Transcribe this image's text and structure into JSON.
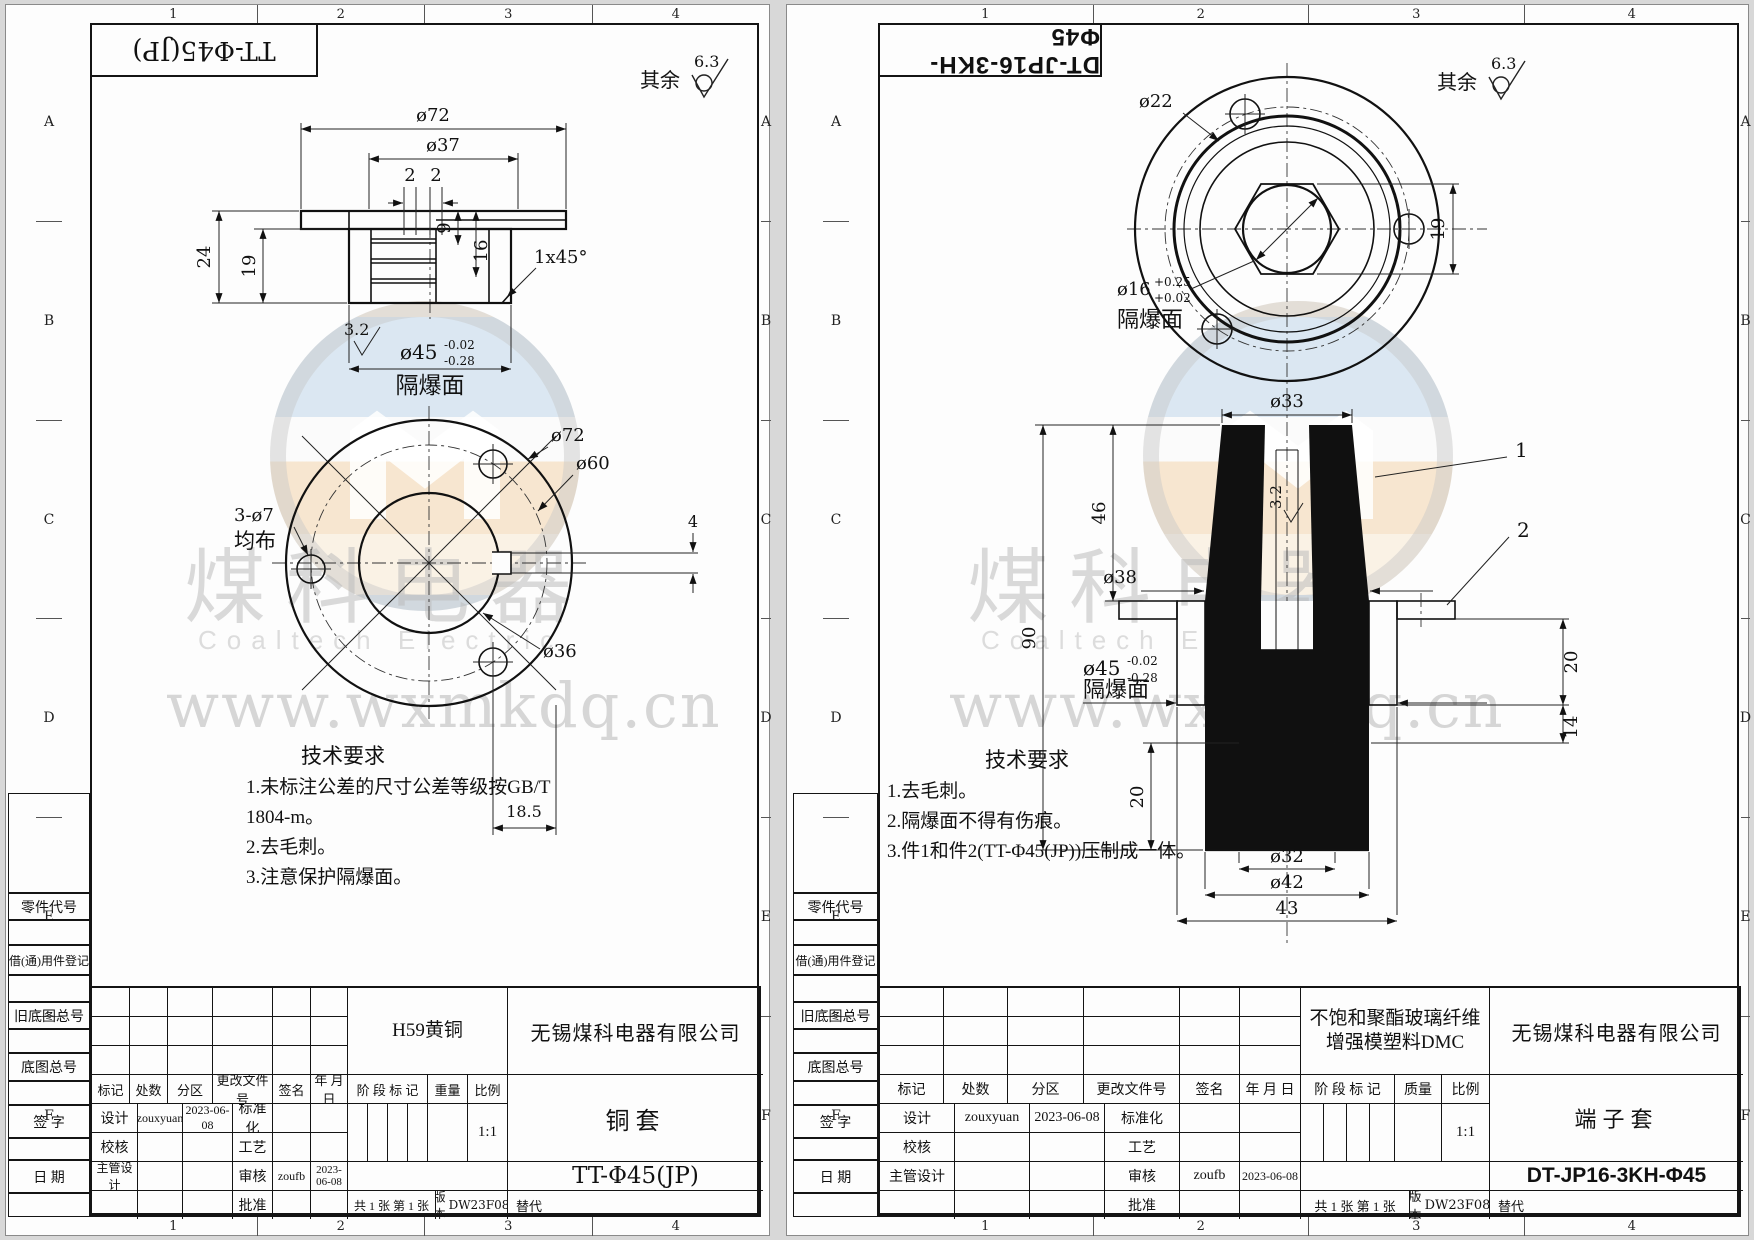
{
  "watermark": {
    "cn": "煤科电器",
    "en": "Coaltech Electric",
    "url": "www.wxmkdq.cn"
  },
  "zones": {
    "c": [
      "1",
      "2",
      "3",
      "4"
    ],
    "r": [
      "A",
      "B",
      "C",
      "D",
      "E",
      "F"
    ]
  },
  "margin_labels": [
    "零件代号",
    "借(通)用件登记",
    "旧底图总号",
    "底图总号",
    "签 字",
    "日 期"
  ],
  "tb_labels": {
    "mark": "标记",
    "count": "处数",
    "zone": "分区",
    "change": "更改文件号",
    "sign": "签名",
    "date": "年 月 日",
    "design": "设计",
    "standardize": "标准化",
    "check": "校核",
    "process": "工艺",
    "chief_design": "主管设计",
    "audit": "审核",
    "approve": "批准",
    "stage": "阶 段 标 记",
    "scale": "比例",
    "sheets": "共 1 张  第 1 张",
    "version": "版本",
    "replace": "替代"
  },
  "left": {
    "stamp": "TT-Φ45(JP)",
    "rough_rest": "其余",
    "rough_val": "6.3",
    "fv": {
      "d72": "ø72",
      "d37": "ø37",
      "g1": "2",
      "g2": "2",
      "h24": "24",
      "h19": "19",
      "d9": "9",
      "d16": "16",
      "chamfer": "1x45°",
      "rough": "3.2",
      "d45": "ø45",
      "d45u": "-0.02",
      "d45d": "-0.28",
      "face": "隔爆面"
    },
    "bv": {
      "d72": "ø72",
      "d60": "ø60",
      "d36": "ø36",
      "holes": "3-ø7",
      "even": "均布",
      "key": "4",
      "off": "18.5"
    },
    "tech": {
      "t": "技术要求",
      "i1": "1.未标注公差的尺寸公差等级按GB/T 1804-m。",
      "i2": "2.去毛刺。",
      "i3": "3.注意保护隔爆面。"
    },
    "tb": {
      "material1": "H59黄铜",
      "material2": "",
      "company": "无锡煤科电器有限公司",
      "part": "铜套",
      "no": "TT-Φ45(JP)",
      "scale": "1:1",
      "weight": "重量",
      "designer": "zouxyuan",
      "ddate": "2023-06-08",
      "auditor": "zoufb",
      "adate": "2023-06-08",
      "version": "DW23F08"
    }
  },
  "right": {
    "stamp": "DT-JP16-3KH-Φ45",
    "rough_rest": "其余",
    "rough_val": "6.3",
    "cv": {
      "d22": "ø22",
      "d16": "ø16",
      "d16u": "+0.25",
      "d16d": "+0.02",
      "face": "隔爆面",
      "h19": "19"
    },
    "sv": {
      "d33": "ø33",
      "h46": "46",
      "h90": "90",
      "d38": "ø38",
      "d45": "ø45",
      "d45u": "-0.02",
      "d45d": "-0.28",
      "face": "隔爆面",
      "rough": "3.2",
      "h20l": "20",
      "h20r": "20",
      "h14": "14",
      "d32": "ø32",
      "d42": "ø42",
      "w43": "43",
      "b1": "1",
      "b2": "2"
    },
    "tech": {
      "t": "技术要求",
      "i1": "1.去毛刺。",
      "i2": "2.隔爆面不得有伤痕。",
      "i3": "3.件1和件2(TT-Φ45(JP))压制成一体。"
    },
    "tb": {
      "material1": "不饱和聚酯玻璃纤维",
      "material2": "增强模塑料DMC",
      "company": "无锡煤科电器有限公司",
      "part": "端子套",
      "no": "DT-JP16-3KH-Φ45",
      "scale": "1:1",
      "weight": "质量",
      "designer": "zouxyuan",
      "ddate": "2023-06-08",
      "auditor": "zoufb",
      "adate": "2023-06-08",
      "version": "DW23F08"
    }
  }
}
